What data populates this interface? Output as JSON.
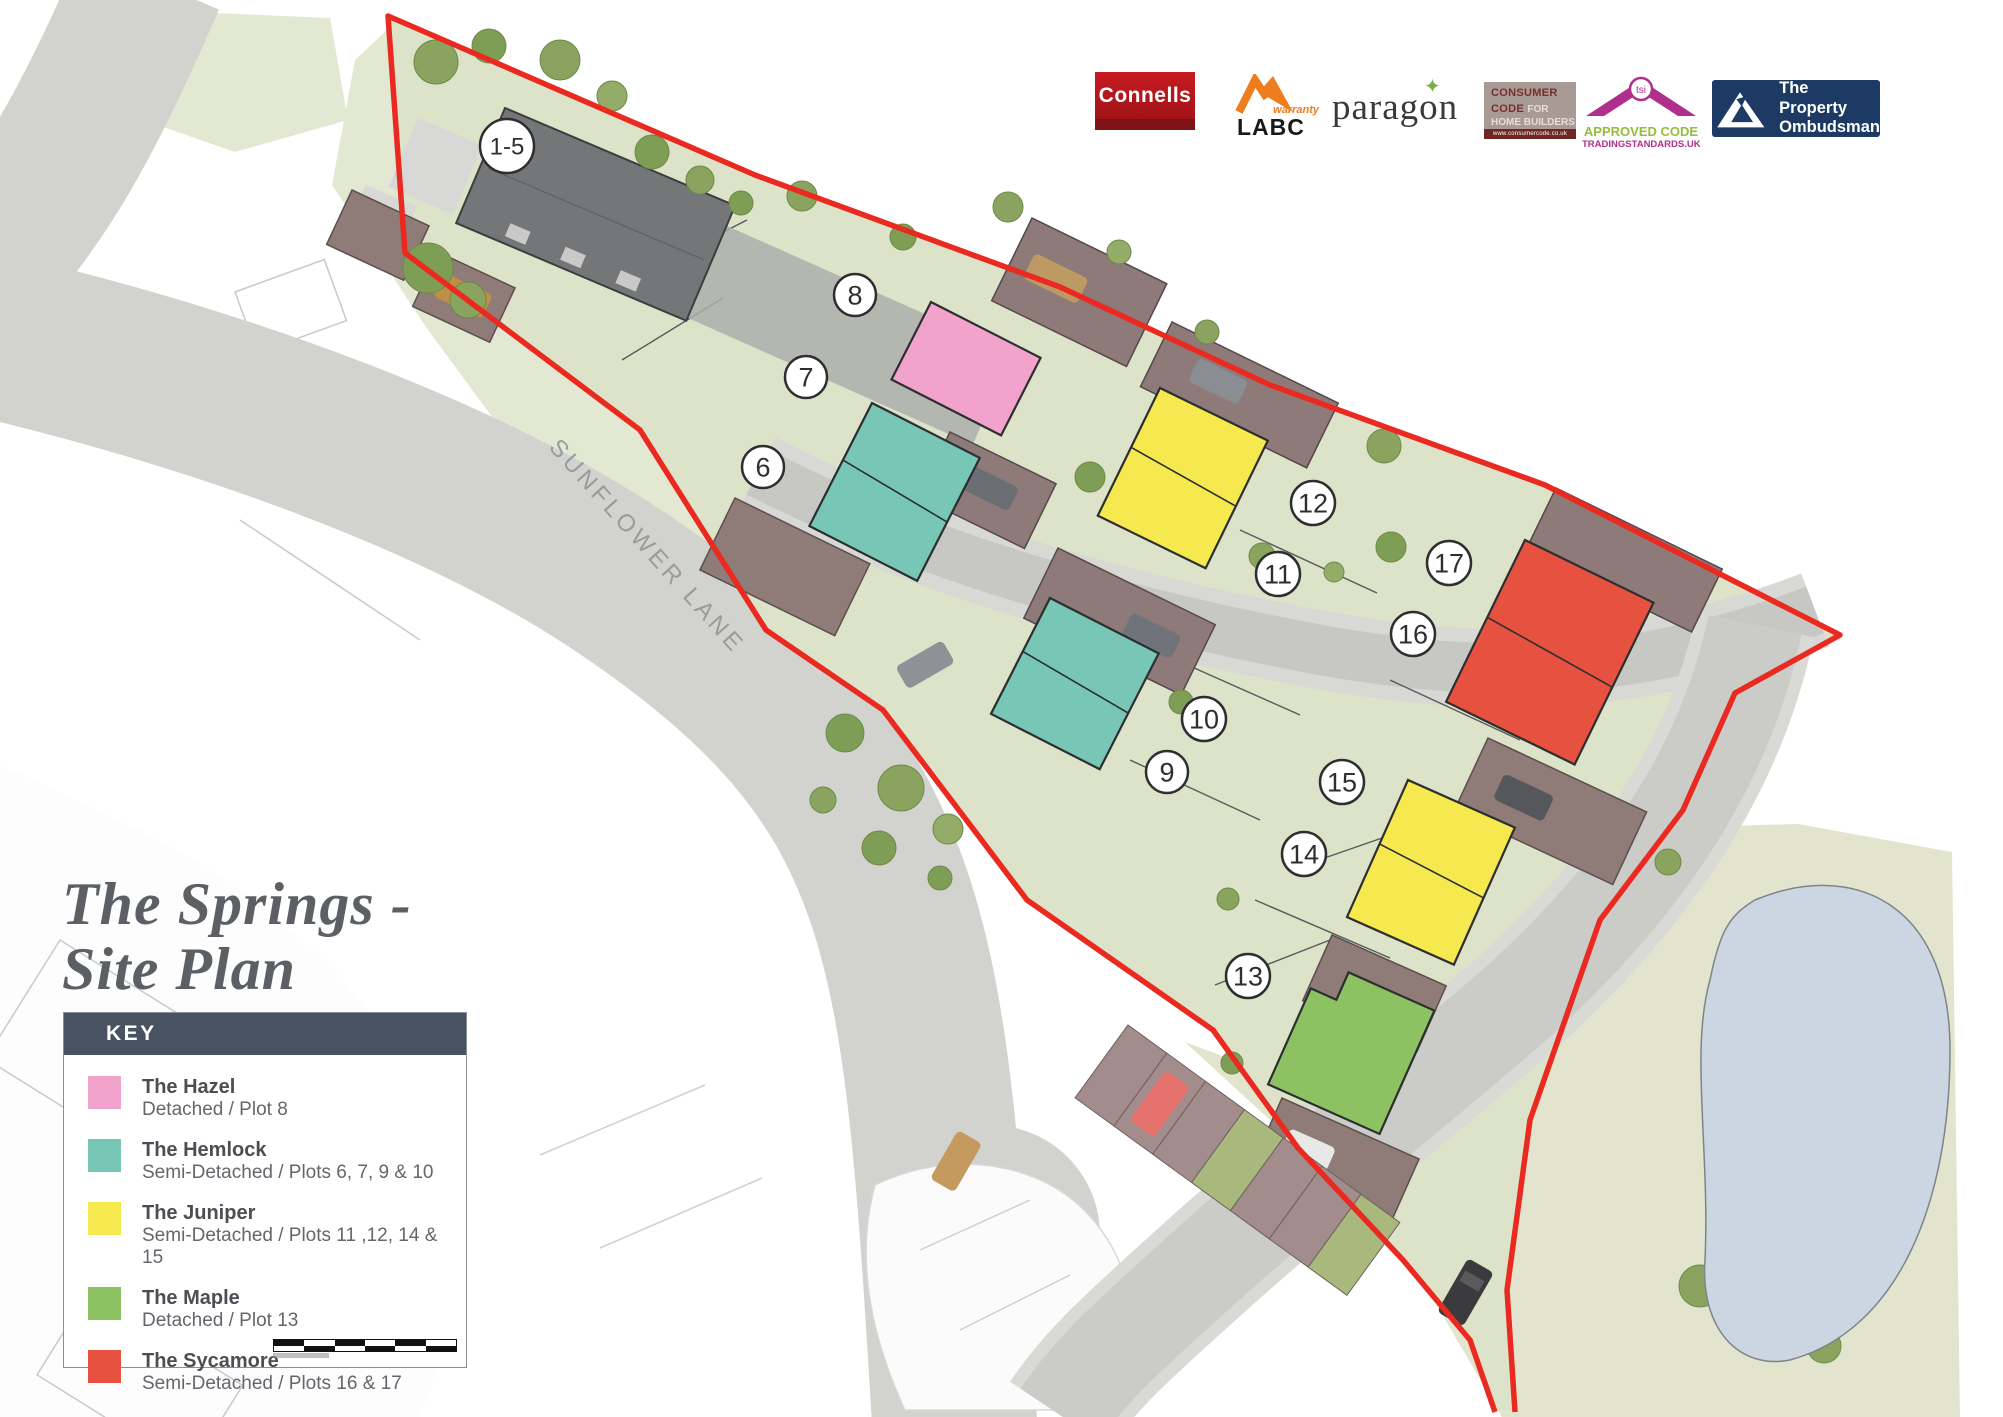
{
  "page": {
    "title_line1": "The Springs -",
    "title_line2": "Site Plan"
  },
  "map": {
    "road_label": "SUNFLOWER LANE"
  },
  "plots": [
    {
      "label": "1-5",
      "x": 507,
      "y": 146
    },
    {
      "label": "6",
      "x": 763,
      "y": 467
    },
    {
      "label": "7",
      "x": 806,
      "y": 377
    },
    {
      "label": "8",
      "x": 855,
      "y": 295
    },
    {
      "label": "9",
      "x": 1167,
      "y": 772
    },
    {
      "label": "10",
      "x": 1204,
      "y": 719
    },
    {
      "label": "11",
      "x": 1278,
      "y": 574
    },
    {
      "label": "12",
      "x": 1313,
      "y": 503
    },
    {
      "label": "13",
      "x": 1248,
      "y": 976
    },
    {
      "label": "14",
      "x": 1304,
      "y": 854
    },
    {
      "label": "15",
      "x": 1342,
      "y": 782
    },
    {
      "label": "16",
      "x": 1413,
      "y": 634
    },
    {
      "label": "17",
      "x": 1449,
      "y": 563
    }
  ],
  "key": {
    "header": "KEY",
    "items": [
      {
        "name": "The Hazel",
        "desc": "Detached / Plot 8",
        "color": "#f2a3cb"
      },
      {
        "name": "The Hemlock",
        "desc": "Semi-Detached / Plots 6, 7, 9 & 10",
        "color": "#77c6b6"
      },
      {
        "name": "The Juniper",
        "desc": "Semi-Detached / Plots 11 ,12, 14 & 15",
        "color": "#f6e94f"
      },
      {
        "name": "The Maple",
        "desc": "Detached / Plot 13",
        "color": "#8cc261"
      },
      {
        "name": "The Sycamore",
        "desc": "Semi-Detached / Plots 16 & 17",
        "color": "#e6523f"
      }
    ]
  },
  "logos": {
    "connells": {
      "text": "Connells"
    },
    "labc": {
      "warranty": "warranty",
      "labc": "LABC"
    },
    "paragon": {
      "text": "paragon"
    },
    "consumer_code": {
      "l1": "CONSUMER",
      "l2a": "CODE ",
      "l2b": "FOR",
      "l3": "HOME BUILDERS",
      "url": "www.consumercode.co.uk"
    },
    "tsi": {
      "circle": "tsi",
      "l1": "APPROVED CODE",
      "l2": "TRADINGSTANDARDS.UK"
    },
    "ombudsman": {
      "l1": "The Property",
      "l2": "Ombudsman"
    }
  },
  "colors": {
    "boundary_red": "#ea2a20",
    "hazel_pink": "#f2a3cb",
    "hemlock_teal": "#77c6b6",
    "juniper_yellow": "#f6e94f",
    "maple_green": "#8cc261",
    "sycamore_red": "#e6523f",
    "road_gray": "#d2d3cf",
    "site_green": "#dce3c9",
    "pond_blue": "#ccd6e2",
    "key_header": "#495260"
  }
}
